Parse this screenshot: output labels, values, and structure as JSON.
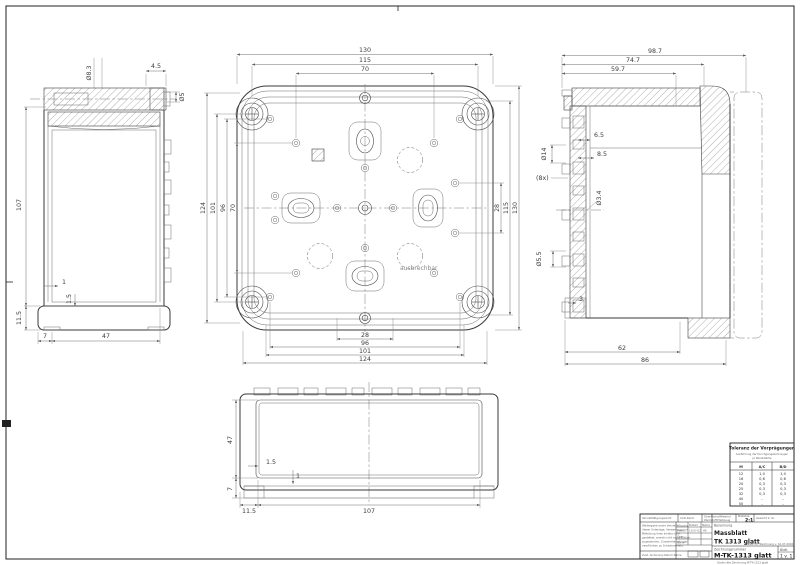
{
  "fv": {
    "note": "ausbrechbar",
    "top": [
      "130",
      "115",
      "70"
    ],
    "left": [
      "124",
      "101",
      "96",
      "70"
    ],
    "right": [
      "28",
      "115",
      "130"
    ],
    "bottom": [
      "28",
      "96",
      "101",
      "124"
    ]
  },
  "lv": {
    "dia1": "Ø8.3",
    "off": "4.5",
    "dia2": "Ø5",
    "h": "107",
    "h2": "11.5",
    "t1": "1",
    "t2": "1.5",
    "b1": "7",
    "b2": "47"
  },
  "rv": {
    "top": [
      "98.7",
      "74.7",
      "59.7"
    ],
    "dia_big": "Ø14",
    "k1": "6.5",
    "k2": "8.5",
    "count": "(8x)",
    "dia_mid": "Ø3.4",
    "dia_small": "Ø5.5",
    "t": "3",
    "bottom": [
      "62",
      "86"
    ]
  },
  "bv": {
    "side": [
      "47",
      "7"
    ],
    "inner": [
      "1.5",
      "1"
    ],
    "bottom": [
      "11.5",
      "107"
    ]
  },
  "tol": {
    "title": "Toleranz der Vorprägungen",
    "sub1": "Ausführung der Durchgangsbohrungen",
    "sub2": "je Wandstärke",
    "cols": [
      "M",
      "A/C",
      "B/D"
    ],
    "rows": [
      [
        "12",
        "1,0",
        "1,0"
      ],
      [
        "16",
        "0,6",
        "0,6"
      ],
      [
        "20",
        "0,3",
        "0,3"
      ],
      [
        "25",
        "0,3",
        "0,3"
      ],
      [
        "32",
        "0,3",
        "0,3"
      ],
      [
        "40",
        "–",
        "–"
      ],
      [
        "50",
        "–",
        "–"
      ]
    ]
  },
  "tb": {
    "c1": "Vervielfältigungsrecht",
    "c2": "CAD-Zeich.",
    "c3a": "Oberfläche/Material",
    "c3b": "Werkstoff/Halbzeug",
    "masstab": "Maßstab",
    "scale": "2:1",
    "c5": "Gewicht in Gr.",
    "datum": "Datum",
    "name": "Name",
    "r1": "Bearb.",
    "r1d": "10.07.02",
    "r1n": "HK",
    "r2": "Gepr.",
    "r3": "Norm",
    "revrow": "Zust.   Änderung   Datum   Name",
    "ben": "Benennung",
    "t1": "Massblatt",
    "t2": "TK 1313 glatt",
    "zn_label": "Zeichnungsnummer",
    "zn": "M-TK-1313 glatt",
    "blatt": "Blatt",
    "blatt_v": "1 v. 1",
    "ersatz": "Ersatz für: Zeichnung v. 10.07.2002",
    "notice": [
      "Weitergabe sowie Vervielfältigung",
      "dieser Unterlage, Verwertung und",
      "Mitteilung ihres Inhalts nicht",
      "gestattet, soweit nicht ausdrücklich",
      "zugestanden. Zuwiderhandlungen",
      "verpflichten zu Schadenersatz."
    ],
    "footer": "Gedruckte Zeichnung M-TK-1313 glatt"
  }
}
